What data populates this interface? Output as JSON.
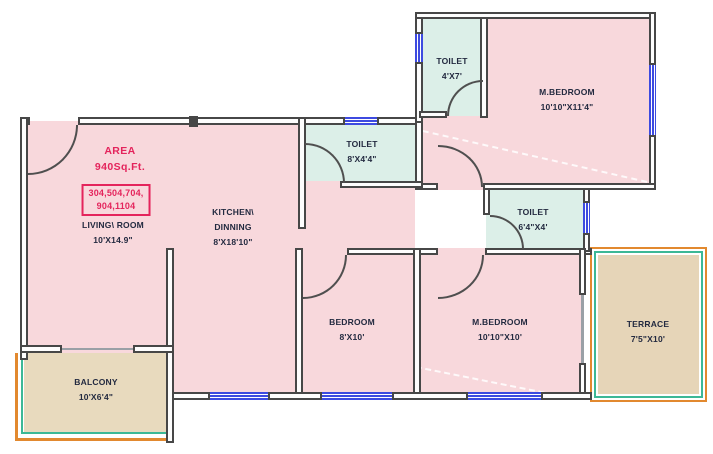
{
  "area": {
    "title": "AREA",
    "value": "940Sq.Ft.",
    "units_line1": "304,504,704,",
    "units_line2": "904,1104"
  },
  "rooms": {
    "living": {
      "line1": "LIVING\\ ROOM",
      "line2": "10'X14.9\""
    },
    "kitchen": {
      "line1": "KITCHEN\\",
      "line2": "DINNING",
      "line3": "8'X18'10\""
    },
    "toilet_mid": {
      "line1": "TOILET",
      "line2": "8'X4'4\""
    },
    "toilet_top": {
      "line1": "TOILET",
      "line2": "4'X7'"
    },
    "toilet_small": {
      "line1": "TOILET",
      "line2": "6'4\"X4'"
    },
    "mbedroom_top": {
      "line1": "M.BEDROOM",
      "line2": "10'10\"X11'4\""
    },
    "bedroom": {
      "line1": "BEDROOM",
      "line2": "8'X10'"
    },
    "mbedroom_bottom": {
      "line1": "M.BEDROOM",
      "line2": "10'10\"X10'"
    },
    "terrace": {
      "line1": "TERRACE",
      "line2": "7'5\"X10'"
    },
    "balcony": {
      "line1": "BALCONY",
      "line2": "10'X6'4\""
    }
  },
  "colors": {
    "wall_outline": "#474747",
    "window": "#3d4ae0",
    "room_pink": "#f8d8dc",
    "toilet_mint": "#dcefe8",
    "balcony_tan": "#e8dabe",
    "terrace_tan": "#e6d5b8",
    "highlight_red": "#e4245c",
    "label_text": "#232a40",
    "terrace_border_orange": "#e2892f",
    "terrace_border_teal": "#3cb896"
  }
}
